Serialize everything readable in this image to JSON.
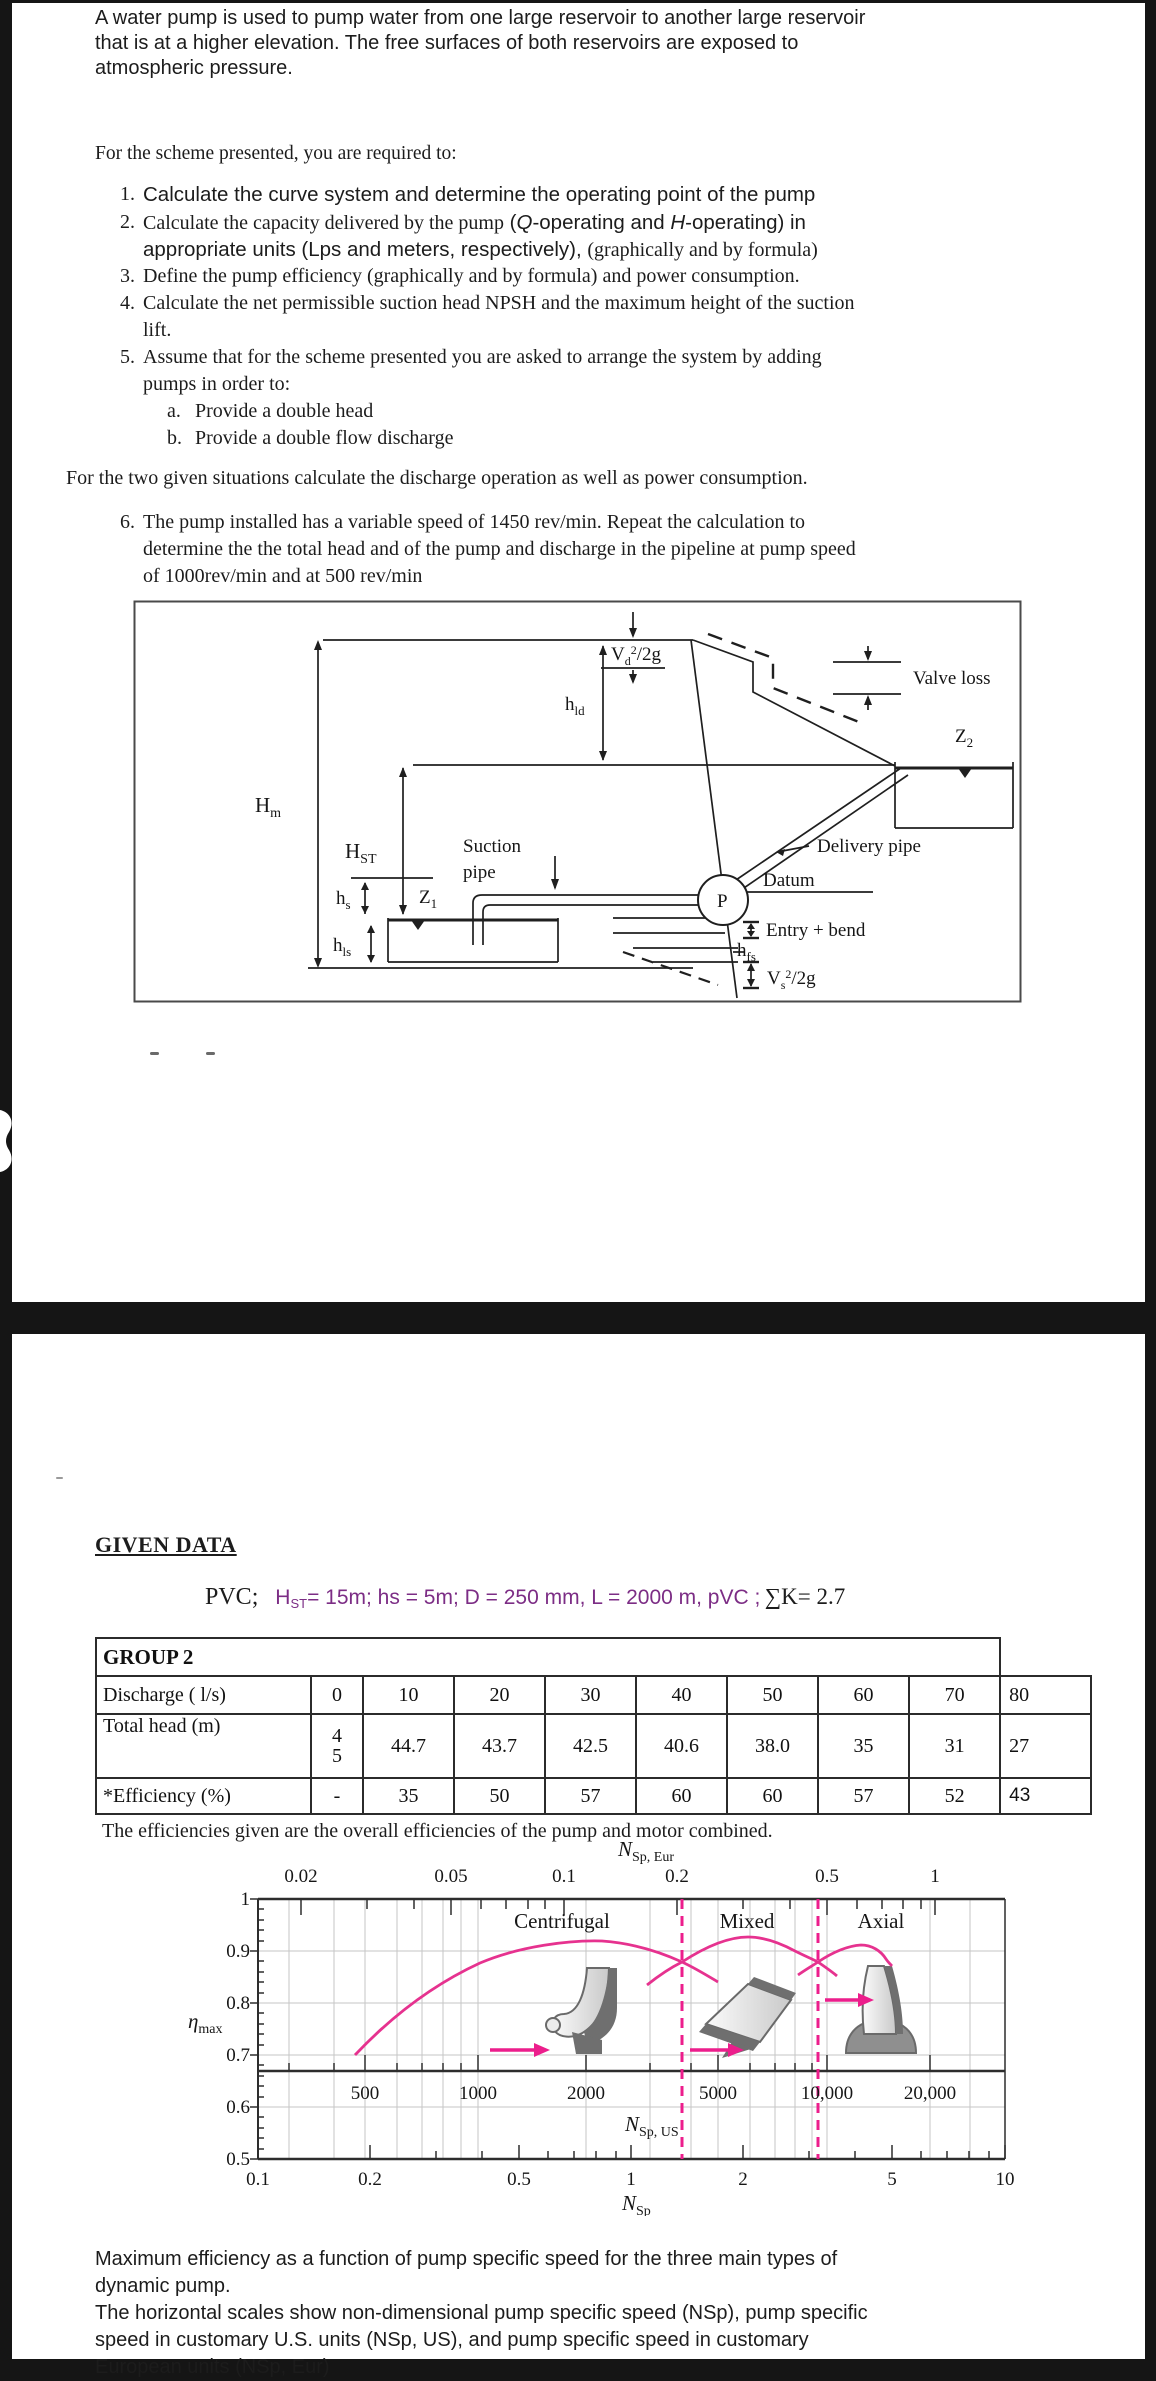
{
  "page1": {
    "para1": {
      "l1": "A water pump is used to pump water from one large reservoir to another large reservoir",
      "l2": "that is at a higher elevation. The free surfaces of both reservoirs are exposed to",
      "l3": "atmospheric pressure."
    },
    "intro": "For the scheme presented, you are required to:",
    "items": {
      "m1": "1.",
      "t1": "Calculate the curve system and determine the operating point of the pump",
      "m2": "2.",
      "t2a": "Calculate the capacity delivered by the pump",
      "t2b": " (",
      "t2c": "Q",
      "t2d": "-operating and ",
      "t2e": "H",
      "t2f": "-operating) in",
      "t2g": "appropriate units (Lps and meters, respectively), ",
      "t2h": "(graphically and by formula)",
      "m3": "3.",
      "t3": "Define the  pump efficiency (graphically and by formula) and power consumption.",
      "m4": "4.",
      "t4a": "Calculate the net permissible suction head NPSH and the maximum height of the suction",
      "t4b": "lift.",
      "m5": "5.",
      "t5a": "Assume that for the scheme presented you are asked to arrange the system by adding",
      "t5b": "pumps in order to:",
      "ma": "a.",
      "ta": "Provide a double head",
      "mb": "b.",
      "tb": "Provide a double flow discharge",
      "m6": "6.",
      "t6a": "The pump installed has a variable speed of 1450 rev/min. Repeat the calculation to",
      "t6b": "determine the the total head and of the pump and discharge in the pipeline at pump speed",
      "t6c": "of 1000rev/min and at 500 rev/min"
    },
    "between": "For the two given situations calculate the discharge operation as well as power consumption.",
    "diagram": {
      "hm_b": "H",
      "hm_s": "m",
      "hst_b": "H",
      "hst_s": "ST",
      "hld_b": "h",
      "hld_s": "ld",
      "vd_b": "V",
      "vd_s": "d",
      "vd_sup": "2",
      "vd_r": "/2g",
      "valve": "Valve loss",
      "z2_b": "Z",
      "z2_s": "2",
      "suction1": "Suction",
      "suction2": "pipe",
      "delivery": "Delivery pipe",
      "datum": "Datum",
      "p": "P",
      "hs_b": "h",
      "hs_s": "s",
      "z1_b": "Z",
      "z1_s": "1",
      "hls_b": "h",
      "hls_s": "ls",
      "entry": "Entry + bend",
      "hfs_b": "h",
      "hfs_s": "fs",
      "vs_b": "V",
      "vs_s": "s",
      "vs_sup": "2",
      "vs_r": "/2g"
    }
  },
  "page2": {
    "heading": "GIVEN DATA",
    "pvc": {
      "prefix": "PVC;",
      "h": "H",
      "hsub": "ST",
      "body": "= 15m; hs = 5m; D = 250 mm, L = 2000 m, pVC ;",
      "sum": "∑K= 2.7"
    },
    "table": {
      "title": "GROUP 2",
      "r1_label": "Discharge ( l/s)",
      "r1": [
        "0",
        "10",
        "20",
        "30",
        "40",
        "50",
        "60",
        "70",
        "80"
      ],
      "r2_label": "Total head (m)",
      "r2_first_top": "4",
      "r2_first_bottom": "5",
      "r2": [
        "44.7",
        "43.7",
        "42.5",
        "40.6",
        "38.0",
        "35",
        "31",
        "27"
      ],
      "r3_label": "*Efficiency (%)",
      "r3": [
        "-",
        "35",
        "50",
        "57",
        "60",
        "60",
        "57",
        "52",
        "43"
      ],
      "note": "The efficiencies given are the overall efficiencies of the pump and motor combined."
    },
    "chart": {
      "eur_title_b": "N",
      "eur_title_s": "Sp, Eur",
      "us_title_b": "N",
      "us_title_s": "Sp, US",
      "nsp_title_b": "N",
      "nsp_title_s": "Sp",
      "eta_title_b": "η",
      "eta_title_s": "max",
      "regions": [
        "Centrifugal",
        "Mixed",
        "Axial"
      ],
      "eur": [
        "0.02",
        "0.05",
        "0.1",
        "0.2",
        "0.5",
        "1"
      ],
      "us": [
        "500",
        "1000",
        "2000",
        "5000",
        "10,000",
        "20,000"
      ],
      "nsp": [
        "0.1",
        "0.2",
        "0.5",
        "1",
        "2",
        "5",
        "10"
      ],
      "eta": [
        "1",
        "0.9",
        "0.8",
        "0.7",
        "0.6",
        "0.5"
      ]
    },
    "caption": {
      "l1": "Maximum efficiency as a function of pump specific speed for the three main types of",
      "l2": "dynamic pump.",
      "l3": "The horizontal scales show non-dimensional pump specific speed (NSp), pump specific",
      "l4": "speed in customary U.S. units (NSp, US), and pump specific speed in customary",
      "l5": "European units (NSp, Eur)"
    }
  },
  "chart_data": {
    "type": "line",
    "title": "Maximum efficiency as a function of pump specific speed for the three main types of dynamic pump",
    "xlabel": "NSp (non-dimensional, log scale); secondary scales: NSp, US and NSp, Eur",
    "ylabel": "ηmax",
    "xlim": [
      0.1,
      10
    ],
    "ylim": [
      0.5,
      1.0
    ],
    "x_scale": "log",
    "grid": true,
    "legend_position": "none",
    "axis_eur_ticks": [
      0.02,
      0.05,
      0.1,
      0.2,
      0.5,
      1
    ],
    "axis_us_ticks": [
      500,
      1000,
      2000,
      5000,
      10000,
      20000
    ],
    "axis_nsp_ticks": [
      0.1,
      0.2,
      0.5,
      1,
      2,
      5,
      10
    ],
    "y_ticks": [
      1,
      0.9,
      0.8,
      0.7,
      0.6,
      0.5
    ],
    "dashed_boundaries_nsp": [
      1.4,
      2.9
    ],
    "series": [
      {
        "name": "Centrifugal",
        "x": [
          0.2,
          0.3,
          0.5,
          0.7,
          0.9,
          1.1,
          1.4,
          1.6,
          1.75
        ],
        "y": [
          0.7,
          0.78,
          0.86,
          0.9,
          0.92,
          0.91,
          0.88,
          0.86,
          0.85
        ]
      },
      {
        "name": "Mixed",
        "x": [
          1.1,
          1.4,
          1.7,
          2.0,
          2.4,
          2.9,
          3.2,
          3.4
        ],
        "y": [
          0.85,
          0.88,
          0.91,
          0.925,
          0.91,
          0.88,
          0.86,
          0.85
        ]
      },
      {
        "name": "Axial",
        "x": [
          2.3,
          2.9,
          3.4,
          4.0,
          4.6,
          5.2
        ],
        "y": [
          0.855,
          0.88,
          0.9,
          0.905,
          0.89,
          0.87
        ]
      }
    ],
    "pump_curve_table": {
      "discharge_lps": [
        0,
        10,
        20,
        30,
        40,
        50,
        60,
        70,
        80
      ],
      "total_head_m": [
        45,
        44.7,
        43.7,
        42.5,
        40.6,
        38.0,
        35,
        31,
        27
      ],
      "efficiency_pct": [
        null,
        35,
        50,
        57,
        60,
        60,
        57,
        52,
        43
      ]
    }
  }
}
